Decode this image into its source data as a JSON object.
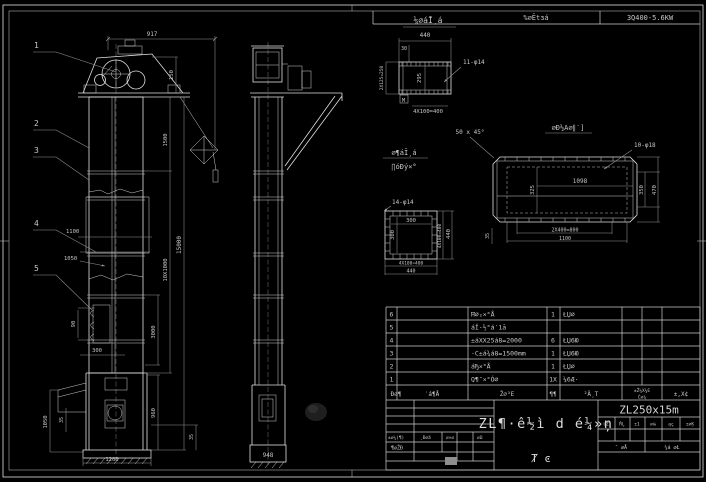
{
  "header": {
    "detail_title": "⅛⌀áĪ¸á",
    "box_mid": "%⌀Ētзá",
    "box_right": "3Q400-5.6KW"
  },
  "front": {
    "balloons": [
      "1",
      "2",
      "3",
      "4",
      "5"
    ],
    "dims": {
      "w917": "917",
      "h150": "150",
      "h1500": "1500",
      "sect": "10X1000",
      "total": "15000",
      "h3000": "3000",
      "d1100": "1100",
      "d1050": "1050",
      "d90": "90",
      "d300": "300",
      "bl1050": "1050",
      "bl35": "35",
      "base": "1200",
      "br960": "960",
      "br35": "35"
    }
  },
  "side": {
    "base": "948"
  },
  "dtop": {
    "d440": "440",
    "d30": "30",
    "left": "2X125=250",
    "holes": "11-φ14",
    "inner": "295",
    "bottom": "4X100=400",
    "m": "M"
  },
  "dsq": {
    "t1": "⌀¶áĪ¸á",
    "t2": "∏óĐý×°",
    "holes": "14-φ14",
    "w": "300",
    "h": "300",
    "r1": "4X100=400",
    "r2": "440",
    "b1": "4X100=400",
    "b2": "440"
  },
  "dlong": {
    "title": "⌀Đ½A⌀∥′]",
    "chamfer": "50 x 45°",
    "holes": "10-φ18",
    "c": "1098",
    "l": "325",
    "r1": "350",
    "r2": "470",
    "b1": "2X400=800",
    "b2": "1100",
    "b3": "35"
  },
  "bom": {
    "header": {
      "c1": "Đ⌀¶",
      "c2": "′á¶Å",
      "c3": "Ž⌀³E",
      "c4": "¶¶",
      "c5": "²Ä¸T",
      "c6a": "±Ž¼X¼E",
      "c6b": "Ć⌀¼",
      "c7": "±,X¢"
    },
    "rows": [
      {
        "no": "6",
        "name": "Ħ⌀₂×°Å",
        "qty": "1",
        "mat": "ŁЏ⌀"
      },
      {
        "no": "5",
        "name": "áĬ·½°á′1ā",
        "qty": "",
        "mat": ""
      },
      {
        "no": "4",
        "name": "±áXX25á8=2000",
        "qty": "6",
        "mat": "ŁЏ6Ю"
      },
      {
        "no": "3",
        "name": "·C±á¾á8=1500mm",
        "qty": "1",
        "mat": "ŁЏ6Ю"
      },
      {
        "no": "2",
        "name": "áЂ×°Å",
        "qty": "1",
        "mat": "ŁЏ⌀"
      },
      {
        "no": "1",
        "name": "Q¶″×°Ó⌀",
        "qty": "1X",
        "mat": "¼6Æ·"
      }
    ]
  },
  "tb": {
    "l1a": "±⌀¼(¶)",
    "l1b": "¸Đ⌀ã",
    "l1c": "⌀×⌀",
    "l1d": "⌀Ω",
    "l2": "¶⌀ŽĐ",
    "title": "ZL¶·ê½ì d é¼»ņ",
    "sub": "Ⱦ   ͼ",
    "model": "ZL250x15m",
    "rh1": "¼Ž",
    "rh2": "ŘĻ",
    "rh3": "±1",
    "rh4": "⌀Ҩ",
    "rh5": "ąç",
    "rh6": "±⌀Ķ",
    "rr1": "″ ⌀Å",
    "rr2": "¼á ⌀Ł"
  }
}
